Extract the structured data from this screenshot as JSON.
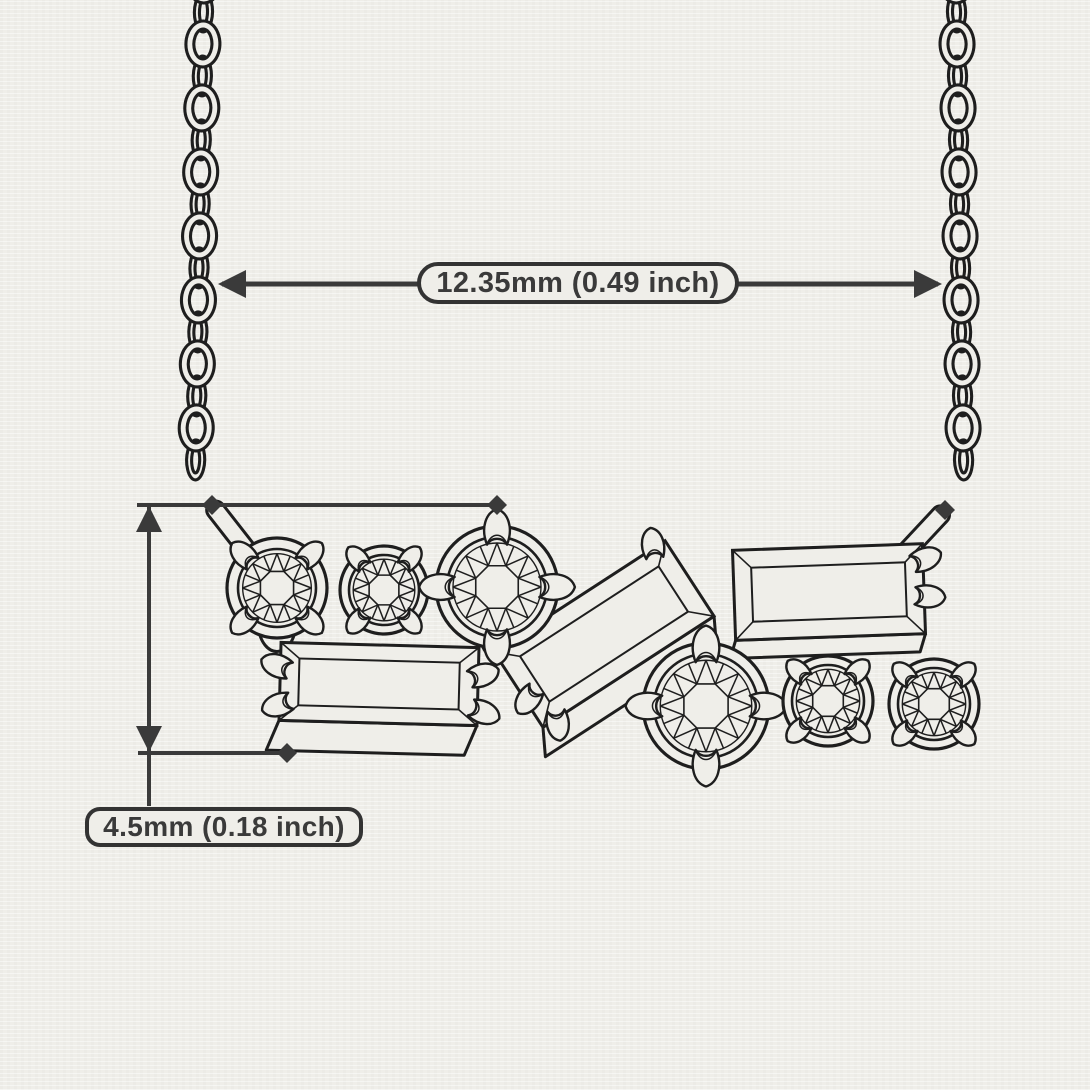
{
  "colors": {
    "paper": "#efeee9",
    "ink": "#1e1e1e",
    "dimension": "#3a3a3a"
  },
  "annotations": {
    "width_label": "12.35mm (0.49 inch)",
    "height_label": "4.5mm (0.18 inch)"
  },
  "drawing": {
    "subject": "technical line sketch of a cluster bar pendant necklace on a cable chain",
    "pendant_stones": [
      {
        "shape": "round brilliant",
        "size": "small",
        "position": "top-left"
      },
      {
        "shape": "round brilliant",
        "size": "small",
        "position": "top-left-2"
      },
      {
        "shape": "round brilliant",
        "size": "large",
        "position": "top-center"
      },
      {
        "shape": "baguette",
        "orientation": "horizontal",
        "position": "bottom-left"
      },
      {
        "shape": "baguette",
        "orientation": "tilted",
        "position": "center"
      },
      {
        "shape": "round brilliant",
        "size": "large",
        "position": "bottom-center"
      },
      {
        "shape": "baguette",
        "orientation": "horizontal",
        "position": "top-right"
      },
      {
        "shape": "round brilliant",
        "size": "small",
        "position": "bottom-right"
      },
      {
        "shape": "round brilliant",
        "size": "small",
        "position": "bottom-right-2"
      }
    ]
  }
}
